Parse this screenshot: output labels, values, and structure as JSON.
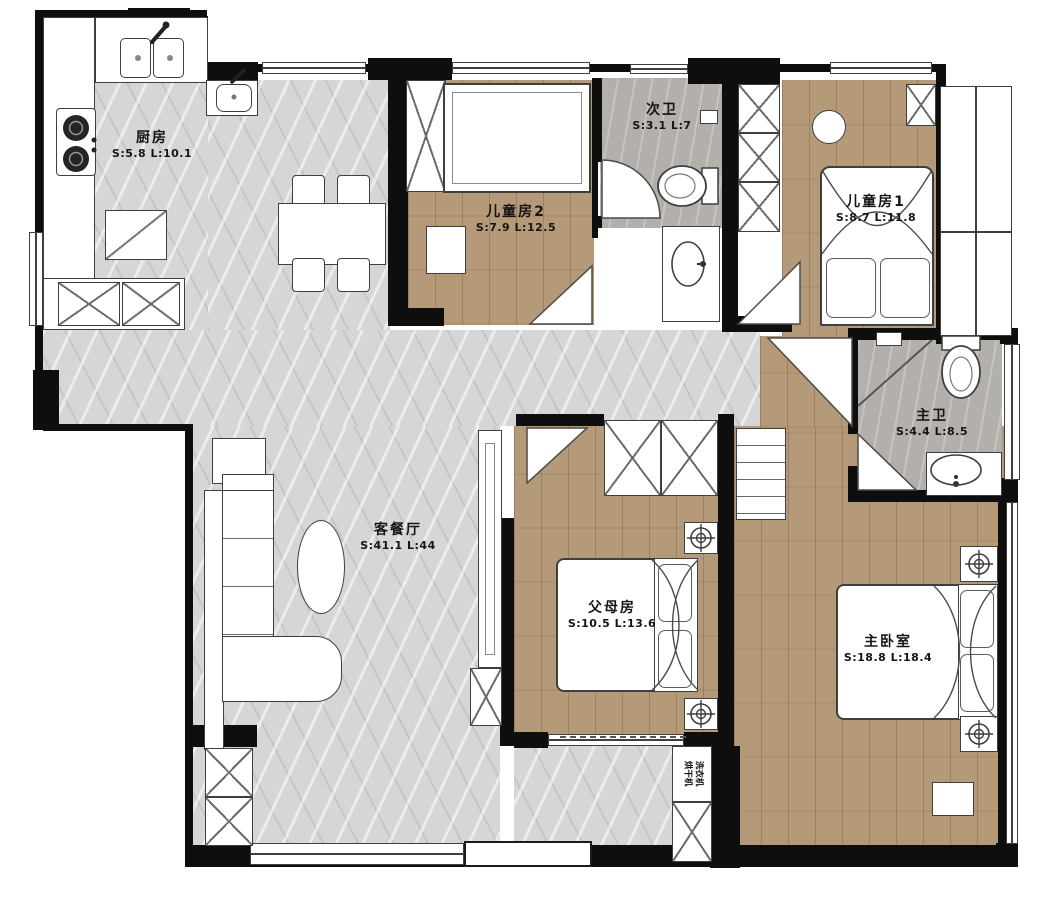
{
  "plan": {
    "rooms": [
      {
        "name": "厨房",
        "area": "S:5.8 L:10.1"
      },
      {
        "name": "儿童房2",
        "area": "S:7.9 L:12.5"
      },
      {
        "name": "次卫",
        "area": "S:3.1 L:7"
      },
      {
        "name": "儿童房1",
        "area": "S:8.7 L:11.8"
      },
      {
        "name": "主卫",
        "area": "S:4.4 L:8.5"
      },
      {
        "name": "客餐厅",
        "area": "S:41.1 L:44"
      },
      {
        "name": "父母房",
        "area": "S:10.5 L:13.6"
      },
      {
        "name": "主卧室",
        "area": "S:18.8 L:18.4"
      }
    ],
    "appliances": {
      "washer": "洗衣机",
      "dryer": "烘干机"
    }
  },
  "colors": {
    "wall": "#0e0e0e",
    "wood": "#b49a78",
    "marble": "#d6d6d6",
    "stone": "#b3b0ac",
    "outline": "#3f3f3f"
  }
}
